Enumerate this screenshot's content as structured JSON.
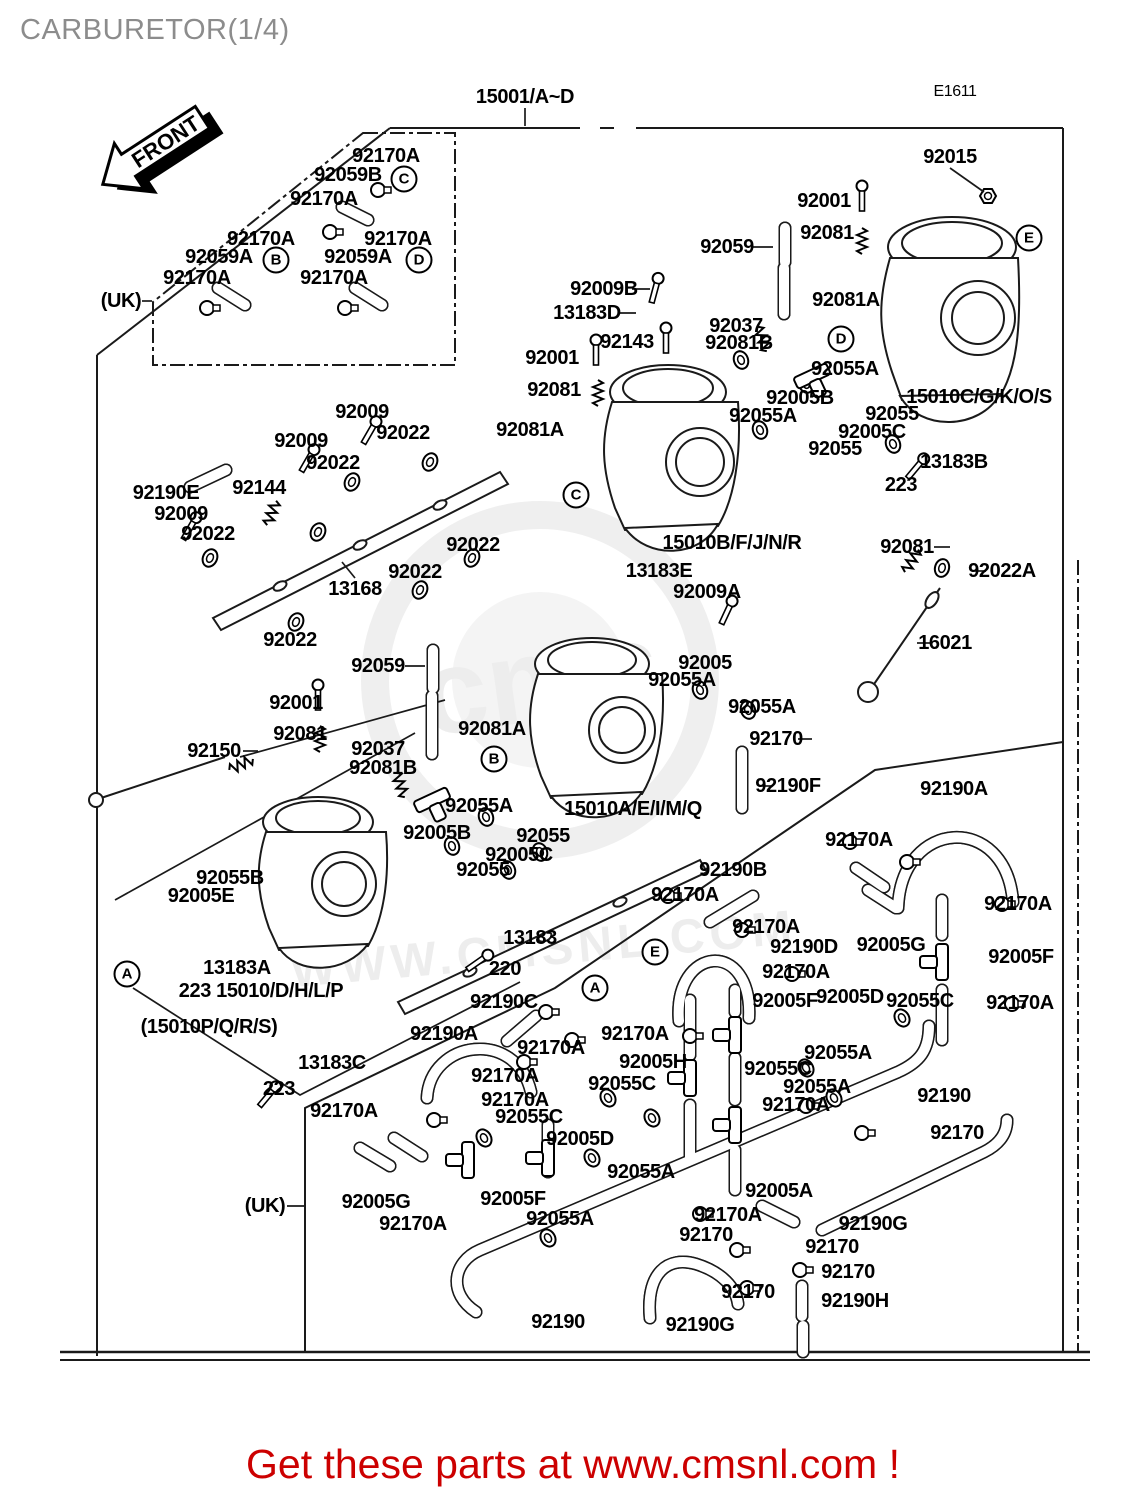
{
  "title": "CARBURETOR(1/4)",
  "header": {
    "assembly_code": "15001/A~D",
    "page_code": "E1611"
  },
  "front_arrow": {
    "label": "FRONT"
  },
  "banner": {
    "text": "Get these parts at www.cmsnl.com !",
    "color": "#cc0000"
  },
  "watermark": {
    "logo_text": "cms",
    "url_text": "WWW.CMSNL.COM"
  },
  "callouts": [
    {
      "letter": "C",
      "x": 404,
      "y": 179
    },
    {
      "letter": "B",
      "x": 276,
      "y": 260
    },
    {
      "letter": "D",
      "x": 419,
      "y": 260
    },
    {
      "letter": "E",
      "x": 1029,
      "y": 238
    },
    {
      "letter": "D",
      "x": 841,
      "y": 339
    },
    {
      "letter": "C",
      "x": 576,
      "y": 495
    },
    {
      "letter": "B",
      "x": 494,
      "y": 759
    },
    {
      "letter": "A",
      "x": 127,
      "y": 974
    },
    {
      "letter": "E",
      "x": 655,
      "y": 952
    },
    {
      "letter": "A",
      "x": 595,
      "y": 988
    }
  ],
  "labels": [
    {
      "text": "15001/A~D",
      "x": 525,
      "y": 97
    },
    {
      "text": "E1611",
      "x": 955,
      "y": 92,
      "s": 16,
      "w": 400
    },
    {
      "text": "92170A",
      "x": 386,
      "y": 156
    },
    {
      "text": "92059B",
      "x": 348,
      "y": 175
    },
    {
      "text": "92170A",
      "x": 324,
      "y": 199
    },
    {
      "text": "92170A",
      "x": 261,
      "y": 239
    },
    {
      "text": "92059A",
      "x": 219,
      "y": 257
    },
    {
      "text": "92170A",
      "x": 197,
      "y": 278
    },
    {
      "text": "92170A",
      "x": 398,
      "y": 239
    },
    {
      "text": "92059A",
      "x": 358,
      "y": 257
    },
    {
      "text": "92170A",
      "x": 334,
      "y": 278
    },
    {
      "text": "(UK)",
      "x": 121,
      "y": 301
    },
    {
      "text": "92015",
      "x": 950,
      "y": 157
    },
    {
      "text": "92001",
      "x": 824,
      "y": 201
    },
    {
      "text": "92081",
      "x": 827,
      "y": 233
    },
    {
      "text": "92059",
      "x": 727,
      "y": 247
    },
    {
      "text": "92081A",
      "x": 846,
      "y": 300
    },
    {
      "text": "92037",
      "x": 736,
      "y": 326
    },
    {
      "text": "92081B",
      "x": 739,
      "y": 343
    },
    {
      "text": "92055A",
      "x": 845,
      "y": 369
    },
    {
      "text": "92005B",
      "x": 800,
      "y": 398
    },
    {
      "text": "92055A",
      "x": 763,
      "y": 416
    },
    {
      "text": "15010C/G/K/O/S",
      "x": 979,
      "y": 397
    },
    {
      "text": "92055",
      "x": 892,
      "y": 414
    },
    {
      "text": "92005C",
      "x": 872,
      "y": 432
    },
    {
      "text": "92055",
      "x": 835,
      "y": 449
    },
    {
      "text": "13183B",
      "x": 954,
      "y": 462
    },
    {
      "text": "223",
      "x": 901,
      "y": 485
    },
    {
      "text": "92009B",
      "x": 604,
      "y": 289
    },
    {
      "text": "13183D",
      "x": 587,
      "y": 313
    },
    {
      "text": "92143",
      "x": 627,
      "y": 342
    },
    {
      "text": "92001",
      "x": 552,
      "y": 358
    },
    {
      "text": "92081",
      "x": 554,
      "y": 390
    },
    {
      "text": "92081A",
      "x": 530,
      "y": 430
    },
    {
      "text": "15010B/F/J/N/R",
      "x": 732,
      "y": 543
    },
    {
      "text": "13183E",
      "x": 659,
      "y": 571
    },
    {
      "text": "92009A",
      "x": 707,
      "y": 592
    },
    {
      "text": "92081",
      "x": 907,
      "y": 547
    },
    {
      "text": "92022A",
      "x": 1002,
      "y": 571
    },
    {
      "text": "16021",
      "x": 945,
      "y": 643
    },
    {
      "text": "92190A",
      "x": 954,
      "y": 789
    },
    {
      "text": "92009",
      "x": 362,
      "y": 412
    },
    {
      "text": "92022",
      "x": 403,
      "y": 433
    },
    {
      "text": "92009",
      "x": 301,
      "y": 441
    },
    {
      "text": "92022",
      "x": 333,
      "y": 463
    },
    {
      "text": "92144",
      "x": 259,
      "y": 488
    },
    {
      "text": "92190E",
      "x": 166,
      "y": 493
    },
    {
      "text": "92009",
      "x": 181,
      "y": 514
    },
    {
      "text": "92022",
      "x": 208,
      "y": 534
    },
    {
      "text": "92022",
      "x": 473,
      "y": 545
    },
    {
      "text": "92022",
      "x": 415,
      "y": 572
    },
    {
      "text": "13168",
      "x": 355,
      "y": 589
    },
    {
      "text": "92022",
      "x": 290,
      "y": 640
    },
    {
      "text": "92059",
      "x": 378,
      "y": 666
    },
    {
      "text": "92001",
      "x": 296,
      "y": 703
    },
    {
      "text": "92081",
      "x": 300,
      "y": 734
    },
    {
      "text": "92150",
      "x": 214,
      "y": 751
    },
    {
      "text": "92037",
      "x": 378,
      "y": 749
    },
    {
      "text": "92081B",
      "x": 383,
      "y": 768
    },
    {
      "text": "92081A",
      "x": 492,
      "y": 729
    },
    {
      "text": "92055A",
      "x": 479,
      "y": 806
    },
    {
      "text": "92005B",
      "x": 437,
      "y": 833
    },
    {
      "text": "92055",
      "x": 543,
      "y": 836
    },
    {
      "text": "92005C",
      "x": 519,
      "y": 855
    },
    {
      "text": "92055",
      "x": 483,
      "y": 870
    },
    {
      "text": "15010A/E/I/M/Q",
      "x": 633,
      "y": 809
    },
    {
      "text": "92005",
      "x": 705,
      "y": 663
    },
    {
      "text": "92055A",
      "x": 682,
      "y": 680
    },
    {
      "text": "92055A",
      "x": 762,
      "y": 707
    },
    {
      "text": "92170",
      "x": 776,
      "y": 739
    },
    {
      "text": "92190F",
      "x": 788,
      "y": 786
    },
    {
      "text": "92055B",
      "x": 230,
      "y": 878
    },
    {
      "text": "92005E",
      "x": 201,
      "y": 896
    },
    {
      "text": "13183A",
      "x": 237,
      "y": 968
    },
    {
      "text": "223 15010/D/H/L/P",
      "x": 261,
      "y": 991
    },
    {
      "text": "(15010P/Q/R/S)",
      "x": 209,
      "y": 1027
    },
    {
      "text": "13183C",
      "x": 332,
      "y": 1063
    },
    {
      "text": "223",
      "x": 279,
      "y": 1089
    },
    {
      "text": "13183",
      "x": 530,
      "y": 938
    },
    {
      "text": "220",
      "x": 505,
      "y": 969
    },
    {
      "text": "92190C",
      "x": 504,
      "y": 1002
    },
    {
      "text": "92190A",
      "x": 444,
      "y": 1034
    },
    {
      "text": "92170A",
      "x": 551,
      "y": 1048
    },
    {
      "text": "92170A",
      "x": 635,
      "y": 1034
    },
    {
      "text": "92170A",
      "x": 505,
      "y": 1076
    },
    {
      "text": "92170A",
      "x": 515,
      "y": 1100
    },
    {
      "text": "92055C",
      "x": 529,
      "y": 1117
    },
    {
      "text": "92005D",
      "x": 580,
      "y": 1139
    },
    {
      "text": "92055A",
      "x": 641,
      "y": 1172
    },
    {
      "text": "92005F",
      "x": 513,
      "y": 1199
    },
    {
      "text": "92055A",
      "x": 560,
      "y": 1219
    },
    {
      "text": "92170A",
      "x": 413,
      "y": 1224
    },
    {
      "text": "92170A",
      "x": 344,
      "y": 1111
    },
    {
      "text": "(UK)",
      "x": 265,
      "y": 1206
    },
    {
      "text": "92005G",
      "x": 376,
      "y": 1202
    },
    {
      "text": "92005H",
      "x": 653,
      "y": 1062
    },
    {
      "text": "92055C",
      "x": 622,
      "y": 1084
    },
    {
      "text": "92005F",
      "x": 785,
      "y": 1001
    },
    {
      "text": "92005D",
      "x": 850,
      "y": 997
    },
    {
      "text": "92055C",
      "x": 778,
      "y": 1069
    },
    {
      "text": "92055A",
      "x": 817,
      "y": 1087
    },
    {
      "text": "92170A",
      "x": 796,
      "y": 1105
    },
    {
      "text": "92005A",
      "x": 779,
      "y": 1191
    },
    {
      "text": "92170A",
      "x": 728,
      "y": 1215
    },
    {
      "text": "92170",
      "x": 706,
      "y": 1235
    },
    {
      "text": "92190G",
      "x": 873,
      "y": 1224
    },
    {
      "text": "92170",
      "x": 832,
      "y": 1247
    },
    {
      "text": "92170",
      "x": 848,
      "y": 1272
    },
    {
      "text": "92190H",
      "x": 855,
      "y": 1301
    },
    {
      "text": "92170",
      "x": 748,
      "y": 1292
    },
    {
      "text": "92190G",
      "x": 700,
      "y": 1325
    },
    {
      "text": "92190",
      "x": 558,
      "y": 1322
    },
    {
      "text": "92190",
      "x": 944,
      "y": 1096
    },
    {
      "text": "92170",
      "x": 957,
      "y": 1133
    },
    {
      "text": "92005G",
      "x": 891,
      "y": 945
    },
    {
      "text": "92005F",
      "x": 1021,
      "y": 957
    },
    {
      "text": "92055C",
      "x": 920,
      "y": 1001
    },
    {
      "text": "92170A",
      "x": 1020,
      "y": 1003
    },
    {
      "text": "92055A",
      "x": 838,
      "y": 1053
    },
    {
      "text": "92190D",
      "x": 804,
      "y": 947
    },
    {
      "text": "92170A",
      "x": 685,
      "y": 895
    },
    {
      "text": "92190B",
      "x": 733,
      "y": 870
    },
    {
      "text": "92170A",
      "x": 766,
      "y": 927
    },
    {
      "text": "92170A",
      "x": 796,
      "y": 972
    },
    {
      "text": "92170A",
      "x": 859,
      "y": 840
    },
    {
      "text": "92170A",
      "x": 1018,
      "y": 904
    }
  ]
}
